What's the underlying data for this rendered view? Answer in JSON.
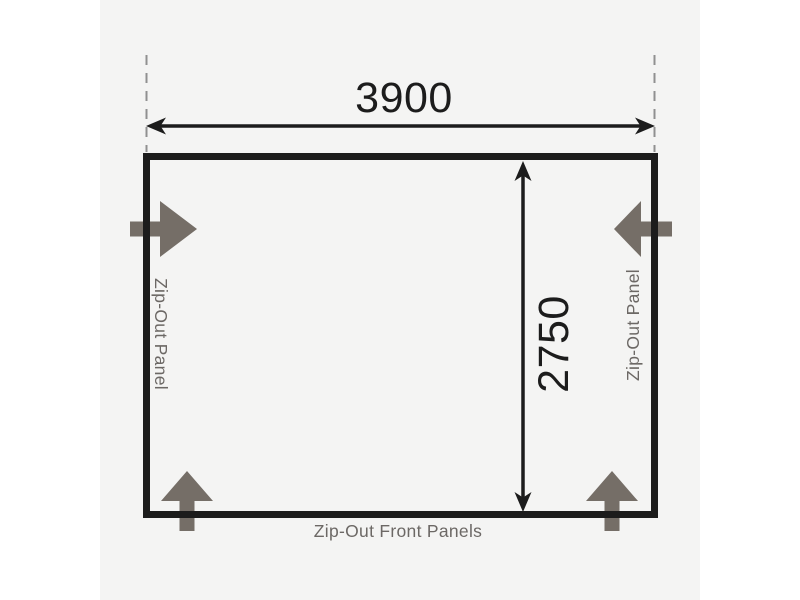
{
  "diagram": {
    "width_mm": "3900",
    "depth_mm": "2750",
    "labels": {
      "left_panel": "Zip-Out Panel",
      "right_panel": "Zip-Out Panel",
      "front_panels": "Zip-Out Front Panels"
    }
  },
  "colors": {
    "page_background": "#ffffff",
    "card_background": "#f4f4f3",
    "outline_black": "#1c1c1c",
    "zip_arrow_gray": "#756e67",
    "label_gray": "#6c6865",
    "guide_dash_gray": "#909090"
  },
  "icons": {
    "side_left": "zip-out-arrow-left-icon",
    "side_right": "zip-out-arrow-right-icon",
    "bottom_left": "zip-out-arrow-bottom-left-icon",
    "bottom_right": "zip-out-arrow-bottom-right-icon",
    "width_dimension": "double-headed-horizontal-arrow-icon",
    "depth_dimension": "double-headed-vertical-arrow-icon"
  }
}
